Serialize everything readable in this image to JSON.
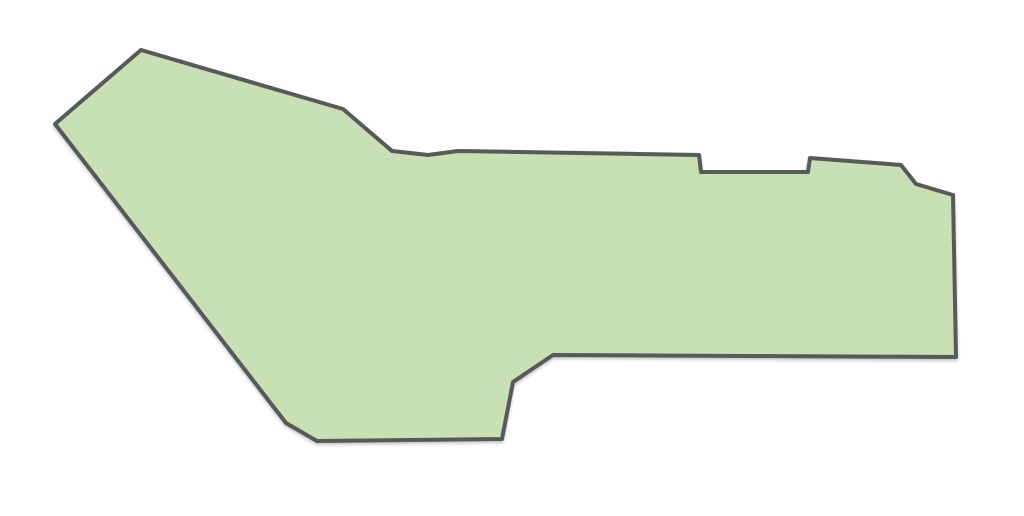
{
  "page": {
    "background_color": "#ffffff",
    "width": 1024,
    "height": 516
  },
  "map": {
    "viewbox": "0 0 1024 516",
    "region": {
      "fill_color": "#c7e0b4",
      "stroke_color": "#59595b",
      "stroke_width": 4,
      "points": [
        [
          55,
          124
        ],
        [
          141,
          50
        ],
        [
          343,
          109
        ],
        [
          392,
          151
        ],
        [
          428,
          155
        ],
        [
          458,
          151
        ],
        [
          699,
          155
        ],
        [
          701,
          172
        ],
        [
          808,
          172
        ],
        [
          810,
          158
        ],
        [
          901,
          165
        ],
        [
          916,
          184
        ],
        [
          953,
          195
        ],
        [
          956,
          357
        ],
        [
          553,
          355
        ],
        [
          513,
          382
        ],
        [
          502,
          439
        ],
        [
          317,
          441
        ],
        [
          286,
          423
        ]
      ]
    }
  }
}
